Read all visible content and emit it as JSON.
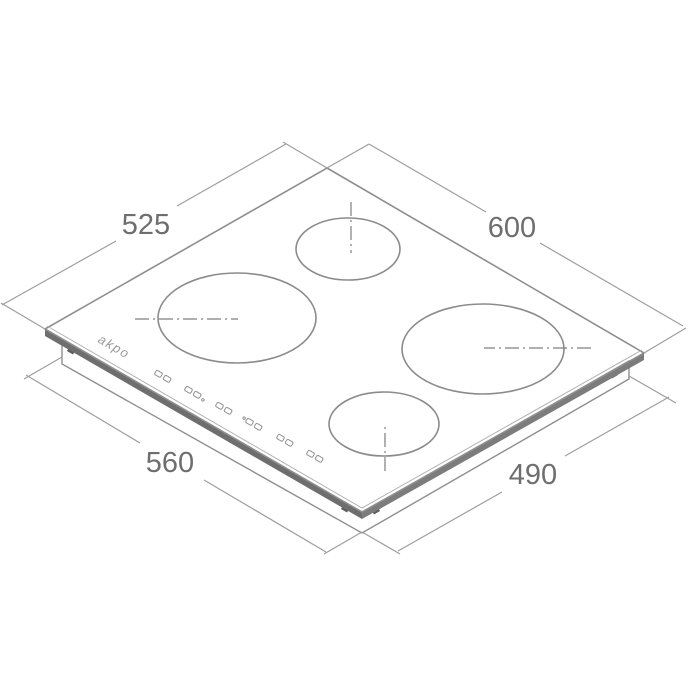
{
  "drawing": {
    "brand_logo": "akpo",
    "dimension_labels": {
      "back_left_edge": "525",
      "back_right_edge": "600",
      "front_left_edge": "560",
      "front_right_edge": "490"
    },
    "colors": {
      "outline": "#8e8e8e",
      "dimension_line": "#9e9e9e",
      "label_text": "#6e6e6e",
      "glass_edge_band": "#6e6e6e",
      "background": "#ffffff"
    },
    "icons": {
      "touch_control": "touch-control-keys-icon",
      "mounting_clip": "mounting-clip-icon",
      "centerline": "dash-dot-centerline"
    }
  }
}
